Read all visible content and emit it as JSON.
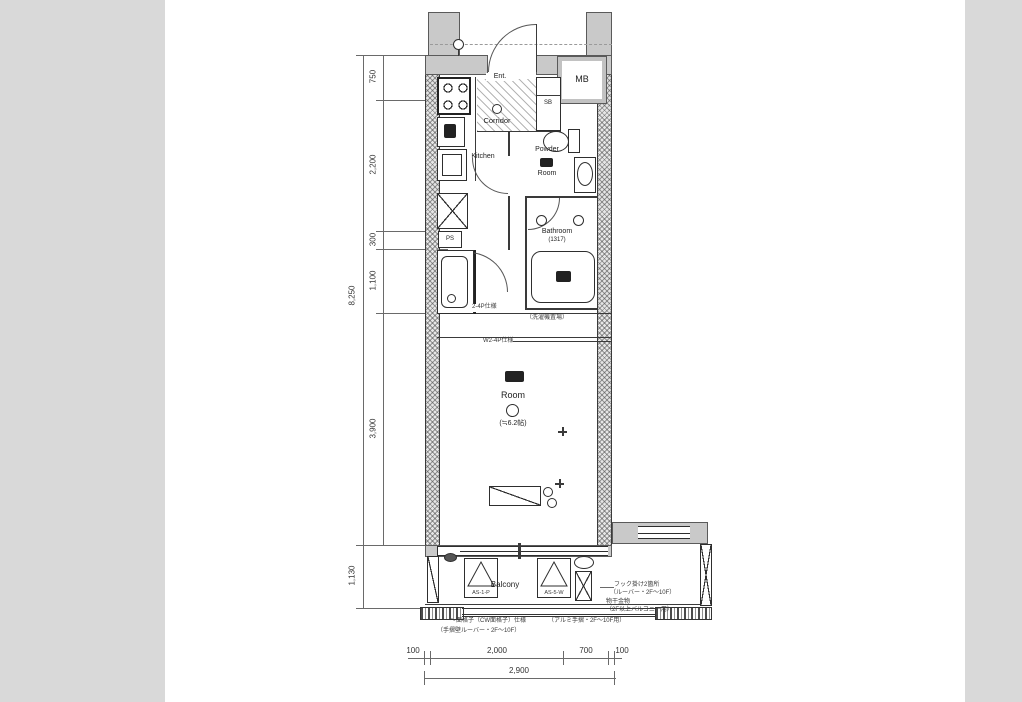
{
  "colors": {
    "canvas_bg": "#d9d9d9",
    "paper_bg": "#ffffff",
    "wall_fill": "#c9c9c9",
    "line": "#2e2e2e"
  },
  "rooms": {
    "entrance": "Ent.",
    "shoe_box": "SB",
    "meter_box": "MB",
    "corridor": "Corridor",
    "kitchen": "Kitchen",
    "powder_room_line1": "Powder",
    "powder_room_line2": "Room",
    "bathroom": "Bathroom",
    "bathroom_size": "(1317)",
    "pipe_space": "PS",
    "main_room": "Room",
    "main_room_size": "(≒6.2帖)",
    "balcony": "Balcony"
  },
  "dimensions": {
    "left_outer_total": "8,250",
    "left_segments": [
      "750",
      "2,200",
      "300",
      "1,100",
      "3,900"
    ],
    "balcony_depth": "1,130",
    "bottom_segments": [
      "100",
      "2,000",
      "700",
      "100"
    ],
    "bottom_total": "2,900"
  },
  "annotations": {
    "mid_1": "2-4P仕様",
    "mid_2": "（洗濯機置場）",
    "mid_3": "W2-4P仕様",
    "balcony_code_1": "AS-1-P",
    "balcony_code_2": "AS-5-W",
    "right_1": "フック掛け2箇所",
    "right_2": "（ルーバー・2F〜10F）",
    "right_3": "物干金物",
    "right_4": "（2F以上バルコニー用）",
    "bottom_1": "〜面格子（CW面格子）仕様",
    "bottom_2": "（アルミ手摺・2F〜10F用）",
    "bottom_3": "（手摺壁ルーバー・2F〜10F）"
  }
}
